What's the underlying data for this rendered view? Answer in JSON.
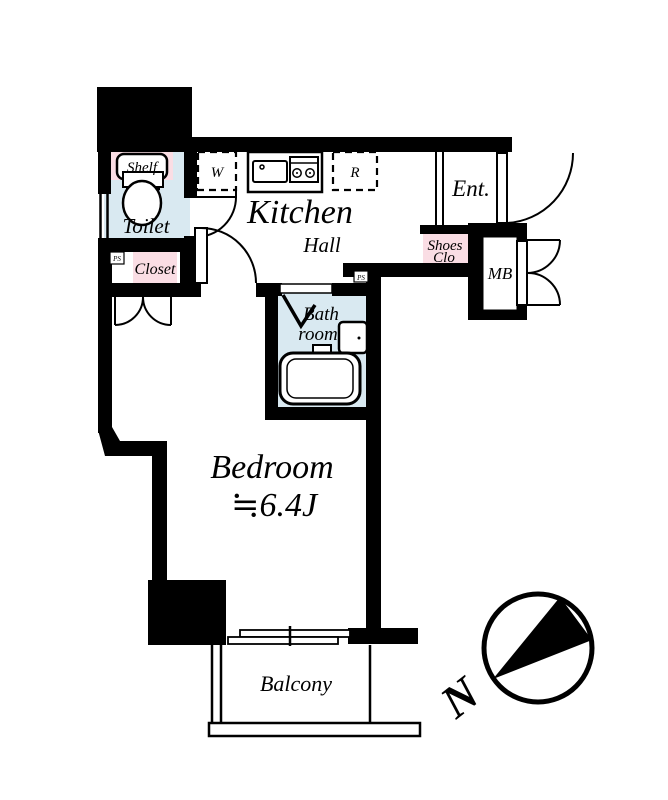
{
  "floor_plan": {
    "rooms": {
      "kitchen": {
        "label": "Kitchen"
      },
      "hall": {
        "label": "Hall"
      },
      "entrance": {
        "label": "Ent."
      },
      "toilet": {
        "label": "Toilet"
      },
      "bathroom": {
        "line1": "Bath",
        "line2": "room"
      },
      "bedroom": {
        "label": "Bedroom",
        "size": "≒6.4J"
      },
      "balcony": {
        "label": "Balcony"
      }
    },
    "storage": {
      "shelf": {
        "label": "Shelf"
      },
      "closet": {
        "label": "Closet"
      },
      "shoes_closet": {
        "line1": "Shoes",
        "line2": "Clo"
      },
      "meter_box": {
        "label": "MB"
      }
    },
    "appliances": {
      "washer": {
        "label": "W"
      },
      "refrigerator": {
        "label": "R"
      }
    },
    "shafts": {
      "ps_left": {
        "label": "PS"
      },
      "ps_center": {
        "label": "PS"
      }
    },
    "compass": {
      "north": "N"
    },
    "colors": {
      "wall": "#000000",
      "wet_area_floor": "#d9e9f1",
      "storage_fill": "#fadde4",
      "background": "#ffffff"
    }
  }
}
